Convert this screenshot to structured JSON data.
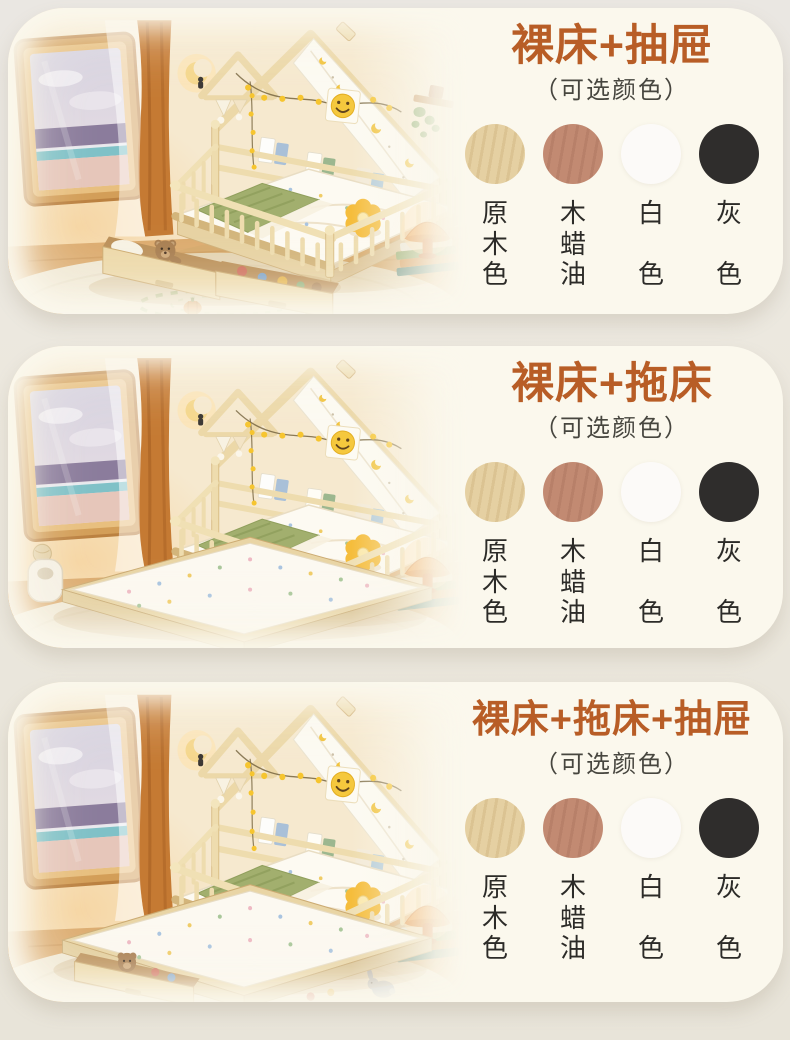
{
  "colors": {
    "page_background": "#eae6dd",
    "panel_background": "#fbf8ed",
    "title_accent": "#b85d26",
    "subtitle_text": "#47463f",
    "label_text": "#2c2b28"
  },
  "panels": [
    {
      "title": "裸床+抽屉",
      "subtitle": "（可选颜色）",
      "photo_alt": "house-frame kids bed with two storage drawers pulled out, teddy bear and toys inside, window with sea view, pumpkin rug",
      "swatches": [
        {
          "name": "原木色",
          "chars": [
            "原",
            "木",
            "色"
          ],
          "color": "#e5d0a2"
        },
        {
          "name": "木蜡油",
          "chars": [
            "木",
            "蜡",
            "油"
          ],
          "color": "#c28a72"
        },
        {
          "name": "白色",
          "chars": [
            "白",
            "色"
          ],
          "color": "#fcfaf8"
        },
        {
          "name": "灰色",
          "chars": [
            "灰",
            "色"
          ],
          "color": "#2f2d2c"
        }
      ]
    },
    {
      "title": "裸床+拖床",
      "subtitle": "（可选颜色）",
      "photo_alt": "house-frame kids bed with trundle bed pulled out showing floral mattress, window with sea view, white basket",
      "swatches": [
        {
          "name": "原木色",
          "chars": [
            "原",
            "木",
            "色"
          ],
          "color": "#e5d0a2"
        },
        {
          "name": "木蜡油",
          "chars": [
            "木",
            "蜡",
            "油"
          ],
          "color": "#c28a72"
        },
        {
          "name": "白色",
          "chars": [
            "白",
            "色"
          ],
          "color": "#fcfaf8"
        },
        {
          "name": "灰色",
          "chars": [
            "灰",
            "色"
          ],
          "color": "#2f2d2c"
        }
      ]
    },
    {
      "title": "裸床+拖床+抽屉",
      "subtitle": "（可选颜色）",
      "photo_alt": "house-frame kids bed with trundle bed and storage drawer pulled out, teddy bear inside drawer, gray bunny toy on rug",
      "swatches": [
        {
          "name": "原木色",
          "chars": [
            "原",
            "木",
            "色"
          ],
          "color": "#e5d0a2"
        },
        {
          "name": "木蜡油",
          "chars": [
            "木",
            "蜡",
            "油"
          ],
          "color": "#c28a72"
        },
        {
          "name": "白色",
          "chars": [
            "白",
            "色"
          ],
          "color": "#fcfaf8"
        },
        {
          "name": "灰色",
          "chars": [
            "灰",
            "色"
          ],
          "color": "#2f2d2c"
        }
      ]
    }
  ]
}
